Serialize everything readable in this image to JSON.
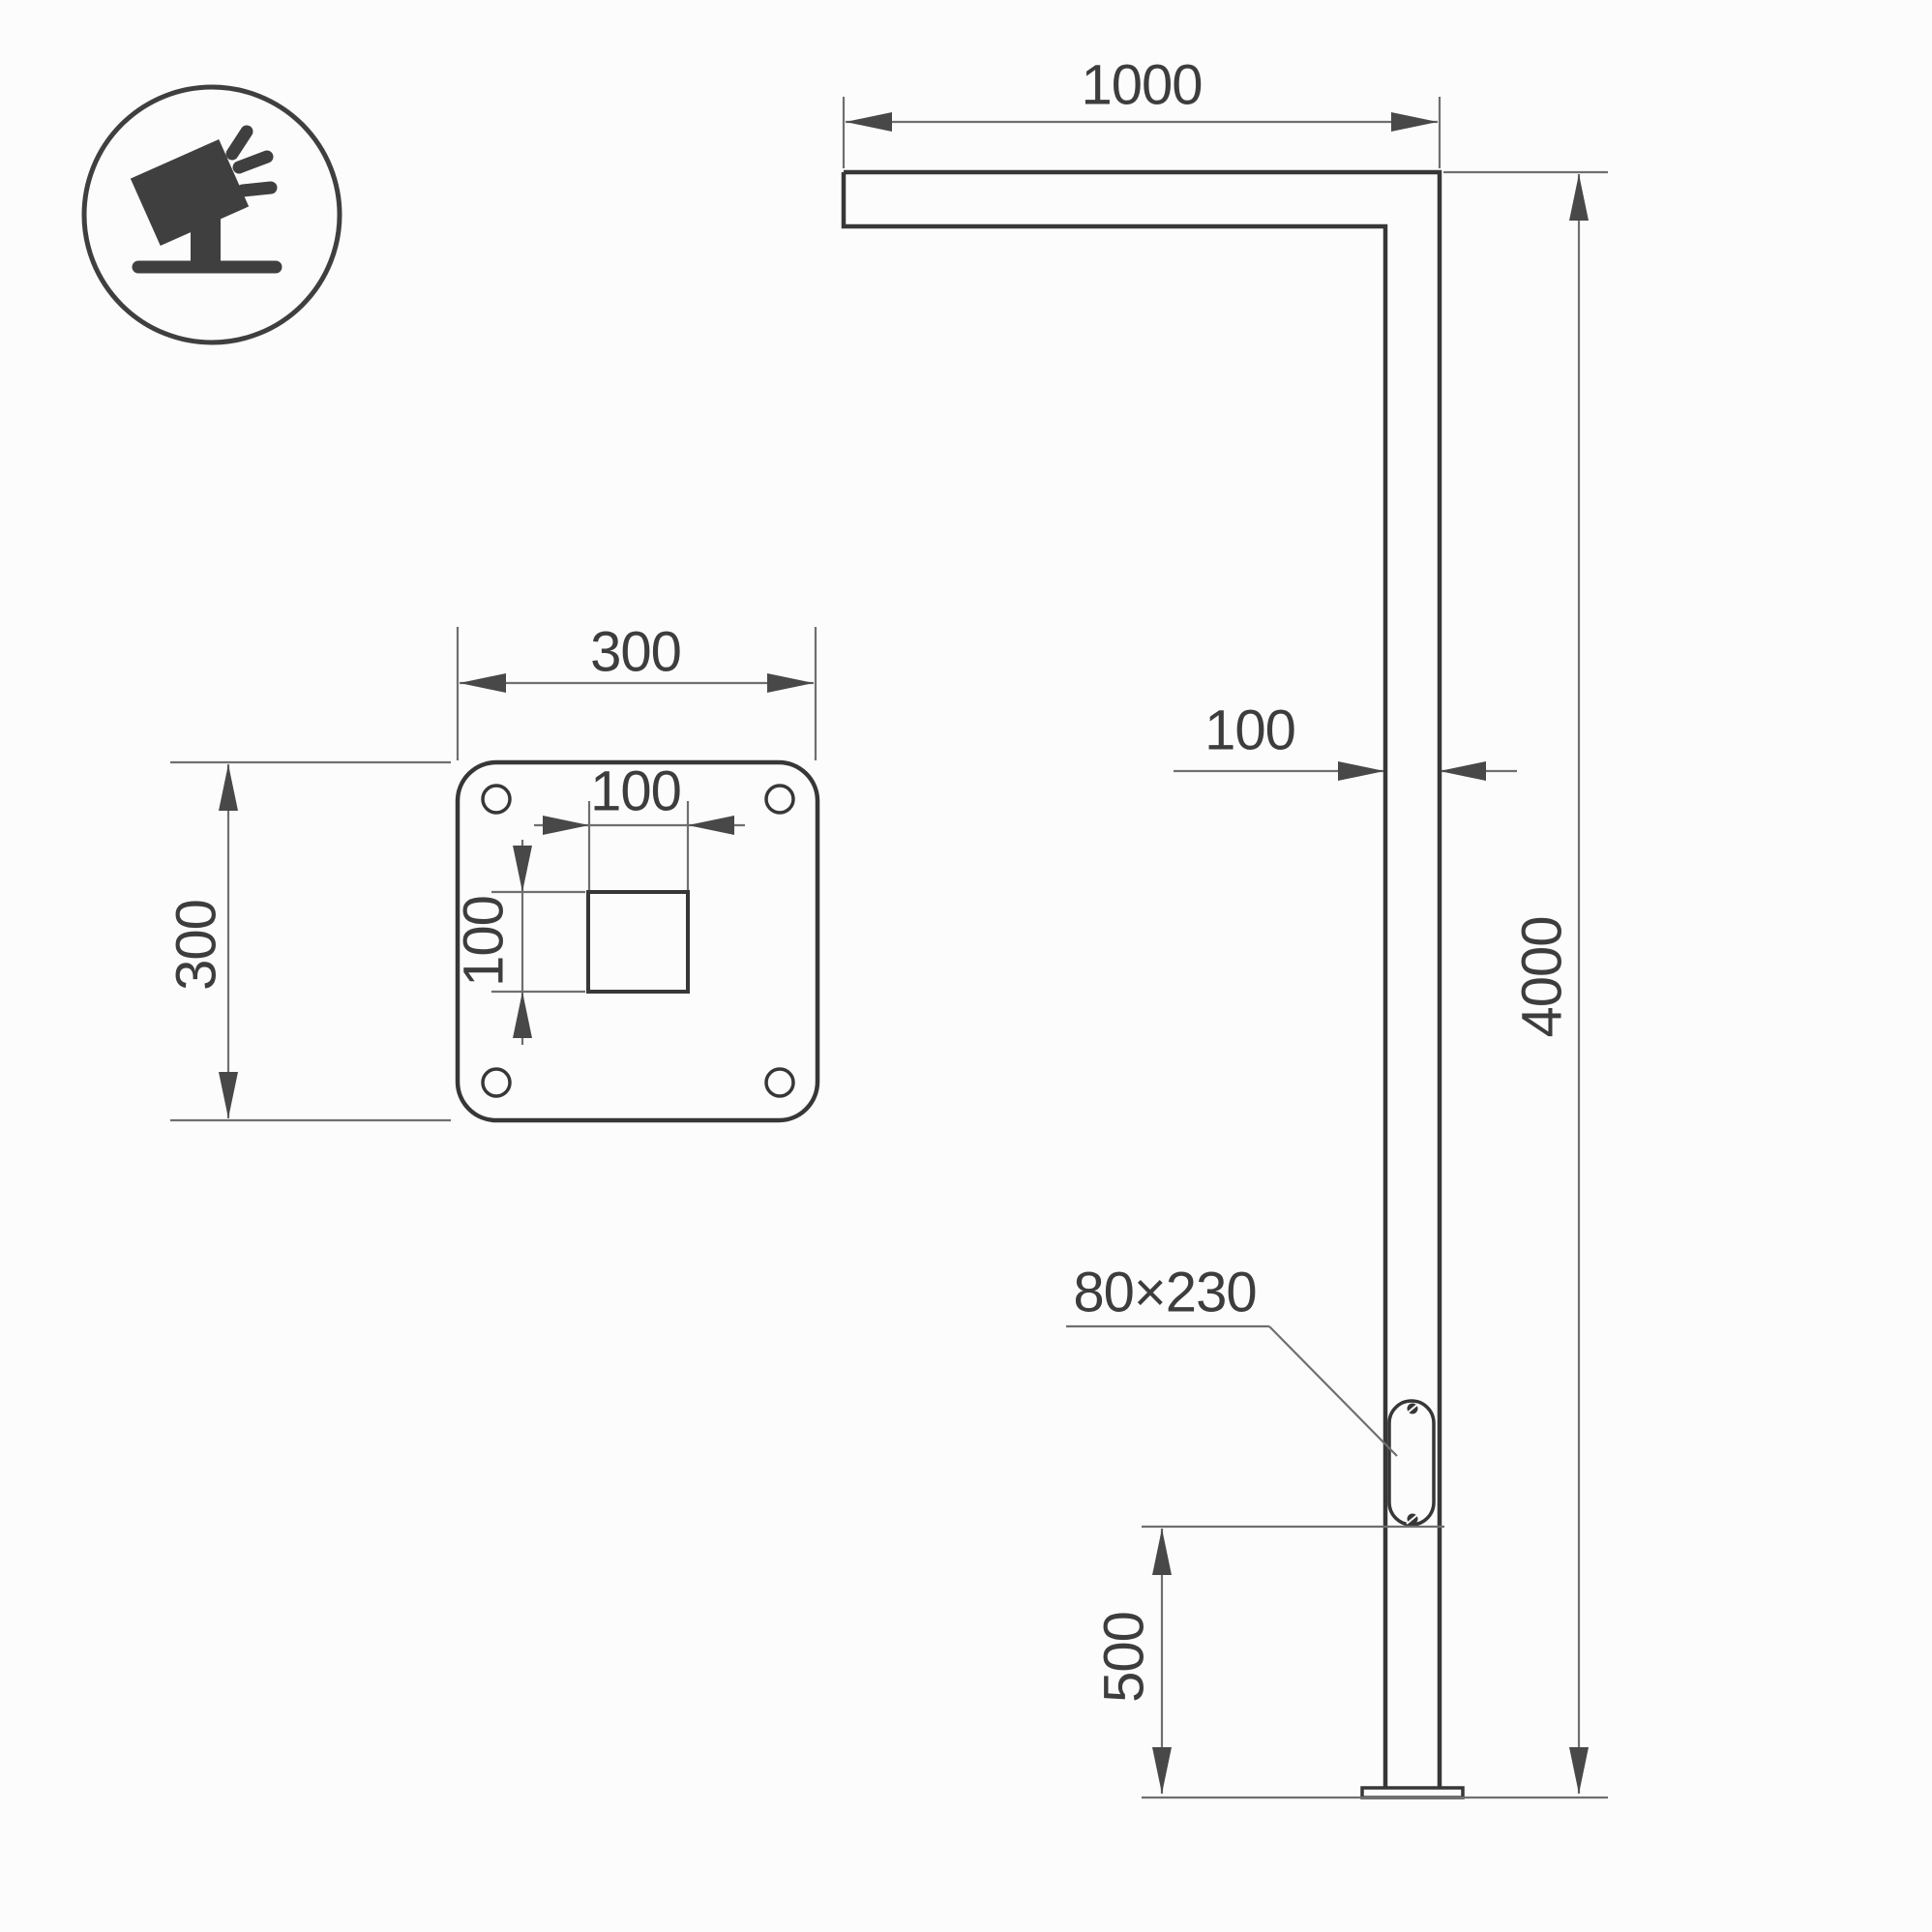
{
  "page": {
    "background": "#fcfcfc",
    "title": "street light pole dimension drawing"
  },
  "palette": {
    "object_line": "#373737",
    "dimension_line": "#6f6f6f",
    "arrow_fill": "#484848",
    "text_color": "#3d3d3d",
    "icon_color": "#3f3f3f"
  },
  "icon": {
    "name": "tilted-floodlight-on-stand"
  },
  "front_view": {
    "arm_length": "1000",
    "pole_width": "100",
    "total_height": "4000",
    "hatch_size": "80×230",
    "hatch_elevation": "500"
  },
  "plate_view": {
    "plate_width": "300",
    "plate_height": "300",
    "hole_width": "100",
    "hole_height": "100"
  }
}
